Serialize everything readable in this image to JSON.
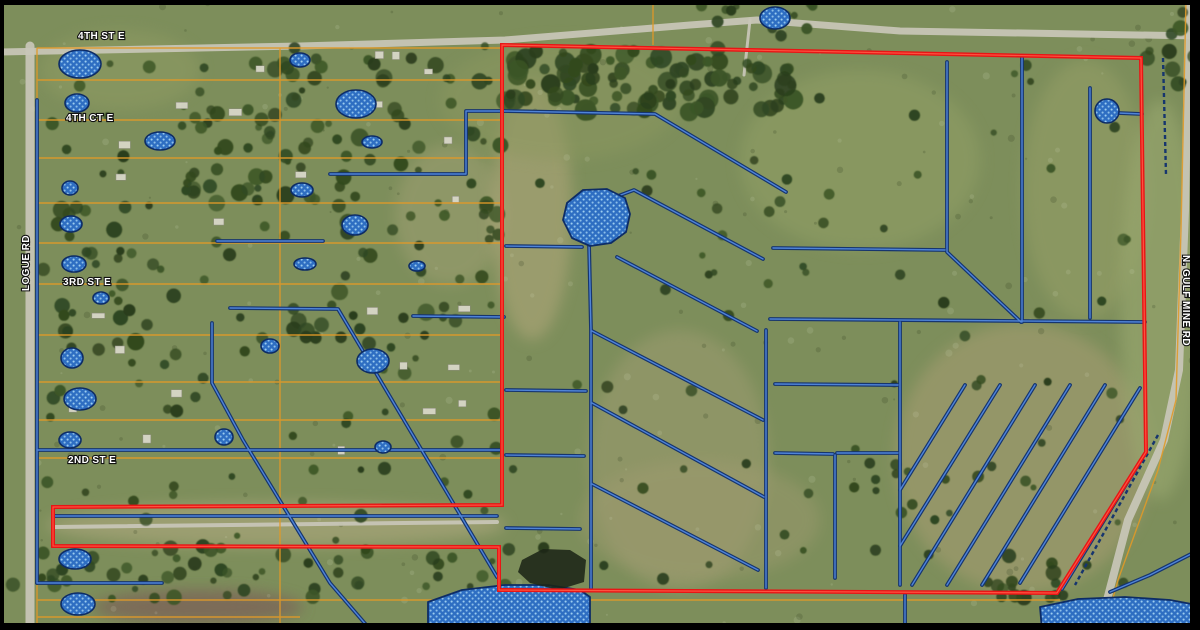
{
  "map": {
    "type": "aerial-parcel-map",
    "road_labels": [
      {
        "id": "4th-st-e",
        "text": "4TH ST E",
        "x": 78,
        "y": 39,
        "rotation": 0
      },
      {
        "id": "4th-ct-e",
        "text": "4TH CT E",
        "x": 66,
        "y": 121,
        "rotation": 0
      },
      {
        "id": "3rd-st-e",
        "text": "3RD ST E",
        "x": 63,
        "y": 285,
        "rotation": 0
      },
      {
        "id": "2nd-st-e",
        "text": "2ND ST E",
        "x": 68,
        "y": 463,
        "rotation": 0
      },
      {
        "id": "logue-rd",
        "text": "LOGUE RD",
        "x": 29,
        "y": 291,
        "rotation": -90
      },
      {
        "id": "n-gulf-mine-rd",
        "text": "N. GULF MINE RD",
        "x": 1183,
        "y": 255,
        "rotation": 90
      }
    ],
    "colors": {
      "boundary_red": "#e81515",
      "boundary_red_hi": "#ff5a45",
      "parcel_orange": "#e09a28",
      "ditch_outer": "#16356e",
      "ditch_inner": "#4f84d8",
      "pond_fill": "#2e6ec2",
      "pond_dot": "#9ccdf0",
      "pond_outline": "#0d2c66",
      "road_gray": "#c9c7b9",
      "label_text": "#ffffff",
      "label_halo": "#111111"
    },
    "boundary": {
      "points": [
        [
          502,
          45
        ],
        [
          1141,
          58
        ],
        [
          1146,
          452
        ],
        [
          1057,
          593
        ],
        [
          499,
          590
        ],
        [
          499,
          547
        ],
        [
          53,
          546
        ],
        [
          53,
          507
        ],
        [
          502,
          505
        ]
      ]
    },
    "parcel_lines": {
      "horizontals": [
        {
          "y": 48,
          "x1": 37,
          "x2": 502
        },
        {
          "y": 80,
          "x1": 37,
          "x2": 502
        },
        {
          "y": 120,
          "x1": 37,
          "x2": 502
        },
        {
          "y": 158,
          "x1": 37,
          "x2": 502
        },
        {
          "y": 203,
          "x1": 37,
          "x2": 502
        },
        {
          "y": 243,
          "x1": 37,
          "x2": 502
        },
        {
          "y": 284,
          "x1": 37,
          "x2": 502
        },
        {
          "y": 335,
          "x1": 37,
          "x2": 502
        },
        {
          "y": 382,
          "x1": 37,
          "x2": 502
        },
        {
          "y": 420,
          "x1": 37,
          "x2": 502
        },
        {
          "y": 458,
          "x1": 37,
          "x2": 502
        },
        {
          "y": 600,
          "x1": 37,
          "x2": 1060
        },
        {
          "y": 617,
          "x1": 37,
          "x2": 300
        }
      ],
      "verticals": [
        {
          "x": 37,
          "y1": 48,
          "y2": 628
        },
        {
          "x": 280,
          "y1": 48,
          "y2": 628
        },
        {
          "x": 653,
          "y1": 4,
          "y2": 45
        }
      ],
      "road_edge": [
        [
          1186,
          0
        ],
        [
          1181,
          230
        ],
        [
          1176,
          400
        ],
        [
          1158,
          470
        ],
        [
          1118,
          580
        ],
        [
          1104,
          630
        ]
      ]
    },
    "ditches": {
      "polylines": [
        [
          [
            330,
            174
          ],
          [
            466,
            174
          ],
          [
            466,
            111
          ],
          [
            504,
            111
          ]
        ],
        [
          [
            504,
            111
          ],
          [
            655,
            114
          ],
          [
            786,
            192
          ]
        ],
        [
          [
            217,
            241
          ],
          [
            323,
            241
          ]
        ],
        [
          [
            230,
            308
          ],
          [
            338,
            309
          ],
          [
            497,
            577
          ]
        ],
        [
          [
            413,
            316
          ],
          [
            504,
            317
          ]
        ],
        [
          [
            212,
            323
          ],
          [
            212,
            383
          ],
          [
            243,
            440
          ],
          [
            330,
            583
          ],
          [
            368,
            627
          ]
        ],
        [
          [
            37,
            450
          ],
          [
            502,
            450
          ]
        ],
        [
          [
            37,
            100
          ],
          [
            37,
            583
          ]
        ],
        [
          [
            55,
            516
          ],
          [
            497,
            516
          ]
        ],
        [
          [
            37,
            583
          ],
          [
            162,
            583
          ]
        ],
        [
          [
            506,
            246
          ],
          [
            582,
            247
          ]
        ],
        [
          [
            506,
            390
          ],
          [
            586,
            391
          ]
        ],
        [
          [
            506,
            455
          ],
          [
            584,
            456
          ]
        ],
        [
          [
            506,
            528
          ],
          [
            580,
            529
          ]
        ],
        [
          [
            589,
            243
          ],
          [
            591,
            330
          ],
          [
            591,
            588
          ]
        ],
        [
          [
            766,
            330
          ],
          [
            766,
            588
          ]
        ],
        [
          [
            618,
            196
          ],
          [
            634,
            190
          ],
          [
            763,
            259
          ]
        ],
        [
          [
            617,
            257
          ],
          [
            757,
            331
          ]
        ],
        [
          [
            592,
            331
          ],
          [
            763,
            420
          ]
        ],
        [
          [
            592,
            403
          ],
          [
            764,
            497
          ]
        ],
        [
          [
            592,
            484
          ],
          [
            758,
            570
          ]
        ],
        [
          [
            947,
            62
          ],
          [
            947,
            252
          ],
          [
            1021,
            322
          ]
        ],
        [
          [
            1022,
            58
          ],
          [
            1022,
            322
          ]
        ],
        [
          [
            1090,
            88
          ],
          [
            1090,
            318
          ]
        ],
        [
          [
            773,
            248
          ],
          [
            945,
            250
          ]
        ],
        [
          [
            770,
            319
          ],
          [
            1145,
            322
          ]
        ],
        [
          [
            1118,
            113
          ],
          [
            1142,
            114
          ]
        ],
        [
          [
            775,
            384
          ],
          [
            898,
            385
          ]
        ],
        [
          [
            775,
            453
          ],
          [
            833,
            454
          ]
        ],
        [
          [
            837,
            453
          ],
          [
            898,
            453
          ]
        ],
        [
          [
            835,
            455
          ],
          [
            835,
            578
          ]
        ],
        [
          [
            900,
            322
          ],
          [
            900,
            585
          ]
        ],
        [
          [
            965,
            385
          ],
          [
            900,
            490
          ]
        ],
        [
          [
            1000,
            385
          ],
          [
            900,
            546
          ]
        ],
        [
          [
            1035,
            385
          ],
          [
            912,
            585
          ]
        ],
        [
          [
            1070,
            385
          ],
          [
            947,
            585
          ]
        ],
        [
          [
            1105,
            385
          ],
          [
            982,
            585
          ]
        ],
        [
          [
            1140,
            388
          ],
          [
            1020,
            583
          ]
        ],
        [
          [
            1141,
            460
          ],
          [
            1062,
            589
          ]
        ],
        [
          [
            1195,
            552
          ],
          [
            1150,
            575
          ],
          [
            1110,
            592
          ]
        ],
        [
          [
            905,
            595
          ],
          [
            905,
            627
          ]
        ]
      ],
      "dashed_polylines": [
        [
          [
            1163,
            58
          ],
          [
            1166,
            175
          ]
        ],
        [
          [
            1158,
            435
          ],
          [
            1075,
            585
          ]
        ]
      ]
    },
    "ponds": {
      "ellipses": [
        [
          80,
          64,
          21,
          14
        ],
        [
          77,
          103,
          12,
          9
        ],
        [
          160,
          141,
          15,
          9
        ],
        [
          70,
          188,
          8,
          7
        ],
        [
          71,
          224,
          11,
          8
        ],
        [
          74,
          264,
          12,
          8
        ],
        [
          101,
          298,
          8,
          6
        ],
        [
          72,
          358,
          11,
          10
        ],
        [
          80,
          399,
          16,
          11
        ],
        [
          70,
          440,
          11,
          8
        ],
        [
          75,
          559,
          16,
          10
        ],
        [
          78,
          604,
          17,
          11
        ],
        [
          300,
          60,
          10,
          7
        ],
        [
          356,
          104,
          20,
          14
        ],
        [
          372,
          142,
          10,
          6
        ],
        [
          302,
          190,
          11,
          7
        ],
        [
          355,
          225,
          13,
          10
        ],
        [
          305,
          264,
          11,
          6
        ],
        [
          417,
          266,
          8,
          5
        ],
        [
          270,
          346,
          9,
          7
        ],
        [
          373,
          361,
          16,
          12
        ],
        [
          224,
          437,
          9,
          8
        ],
        [
          383,
          447,
          8,
          6
        ],
        [
          775,
          18,
          15,
          11
        ],
        [
          1107,
          111,
          12,
          12
        ]
      ],
      "polygons": [
        [
          [
            567,
            203
          ],
          [
            583,
            190
          ],
          [
            607,
            189
          ],
          [
            625,
            198
          ],
          [
            630,
            214
          ],
          [
            626,
            232
          ],
          [
            611,
            243
          ],
          [
            590,
            246
          ],
          [
            572,
            238
          ],
          [
            563,
            220
          ]
        ],
        [
          [
            428,
            602
          ],
          [
            462,
            590
          ],
          [
            505,
            585
          ],
          [
            548,
            585
          ],
          [
            580,
            590
          ],
          [
            590,
            597
          ],
          [
            590,
            628
          ],
          [
            428,
            628
          ]
        ],
        [
          [
            1040,
            607
          ],
          [
            1078,
            599
          ],
          [
            1125,
            597
          ],
          [
            1170,
            600
          ],
          [
            1197,
            605
          ],
          [
            1197,
            630
          ],
          [
            1042,
            630
          ]
        ]
      ]
    },
    "dark_pond": [
      [
        522,
        560
      ],
      [
        543,
        549
      ],
      [
        570,
        550
      ],
      [
        586,
        560
      ],
      [
        584,
        582
      ],
      [
        558,
        590
      ],
      [
        530,
        583
      ],
      [
        518,
        572
      ]
    ],
    "roads": {
      "polylines": [
        {
          "pts": [
            [
              0,
              52
            ],
            [
              300,
              46
            ],
            [
              505,
              40
            ],
            [
              690,
              25
            ],
            [
              757,
              20
            ],
            [
              900,
              31
            ],
            [
              1200,
              36
            ]
          ],
          "w": 7
        },
        {
          "pts": [
            [
              30,
              46
            ],
            [
              30,
              630
            ]
          ],
          "w": 9
        },
        {
          "pts": [
            [
              1189,
              0
            ],
            [
              1185,
              210
            ],
            [
              1179,
              370
            ],
            [
              1164,
              440
            ],
            [
              1128,
              520
            ],
            [
              1107,
              600
            ],
            [
              1103,
              630
            ]
          ],
          "w": 8
        },
        {
          "pts": [
            [
              55,
              527
            ],
            [
              497,
              522
            ]
          ],
          "w": 4
        },
        {
          "pts": [
            [
              750,
              20
            ],
            [
              744,
              75
            ]
          ],
          "w": 3
        }
      ]
    }
  }
}
